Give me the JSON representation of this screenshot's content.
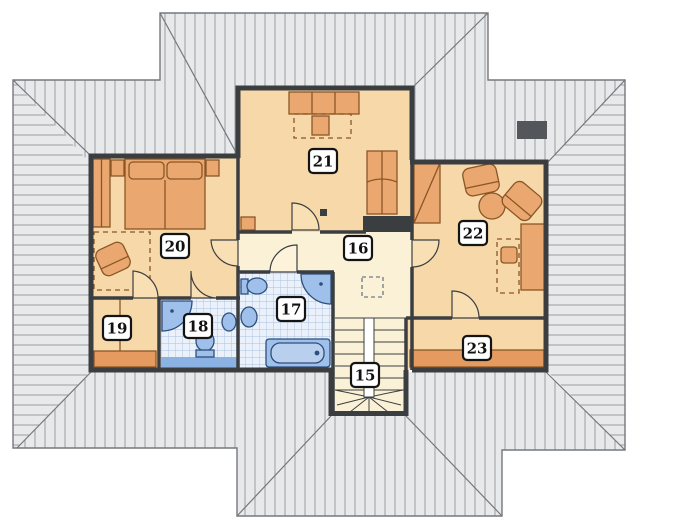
{
  "plan": {
    "type": "floor-plan-upper-storey",
    "rooms": [
      {
        "number": "15"
      },
      {
        "number": "16"
      },
      {
        "number": "17"
      },
      {
        "number": "18"
      },
      {
        "number": "19"
      },
      {
        "number": "20"
      },
      {
        "number": "21"
      },
      {
        "number": "22"
      },
      {
        "number": "23"
      }
    ],
    "colors": {
      "roof_fill": "#e8e9eb",
      "roof_hatch": "#9a9da2",
      "roof_edge": "#74787c",
      "wall": "#3b3e41",
      "floor_tan": "#f7d8a9",
      "floor_cream": "#fbf1d6",
      "tile_blue_bg": "#eaf1fa",
      "tile_blue_grid": "#a8c0de",
      "fixture_blue": "#9fc0ea",
      "fixture_outline": "#2e4e7c",
      "furniture_orange": "#eaa76f",
      "furniture_outline": "#8a5627",
      "band_orange": "#e59a5f",
      "chimney_gray": "#53575b"
    }
  }
}
